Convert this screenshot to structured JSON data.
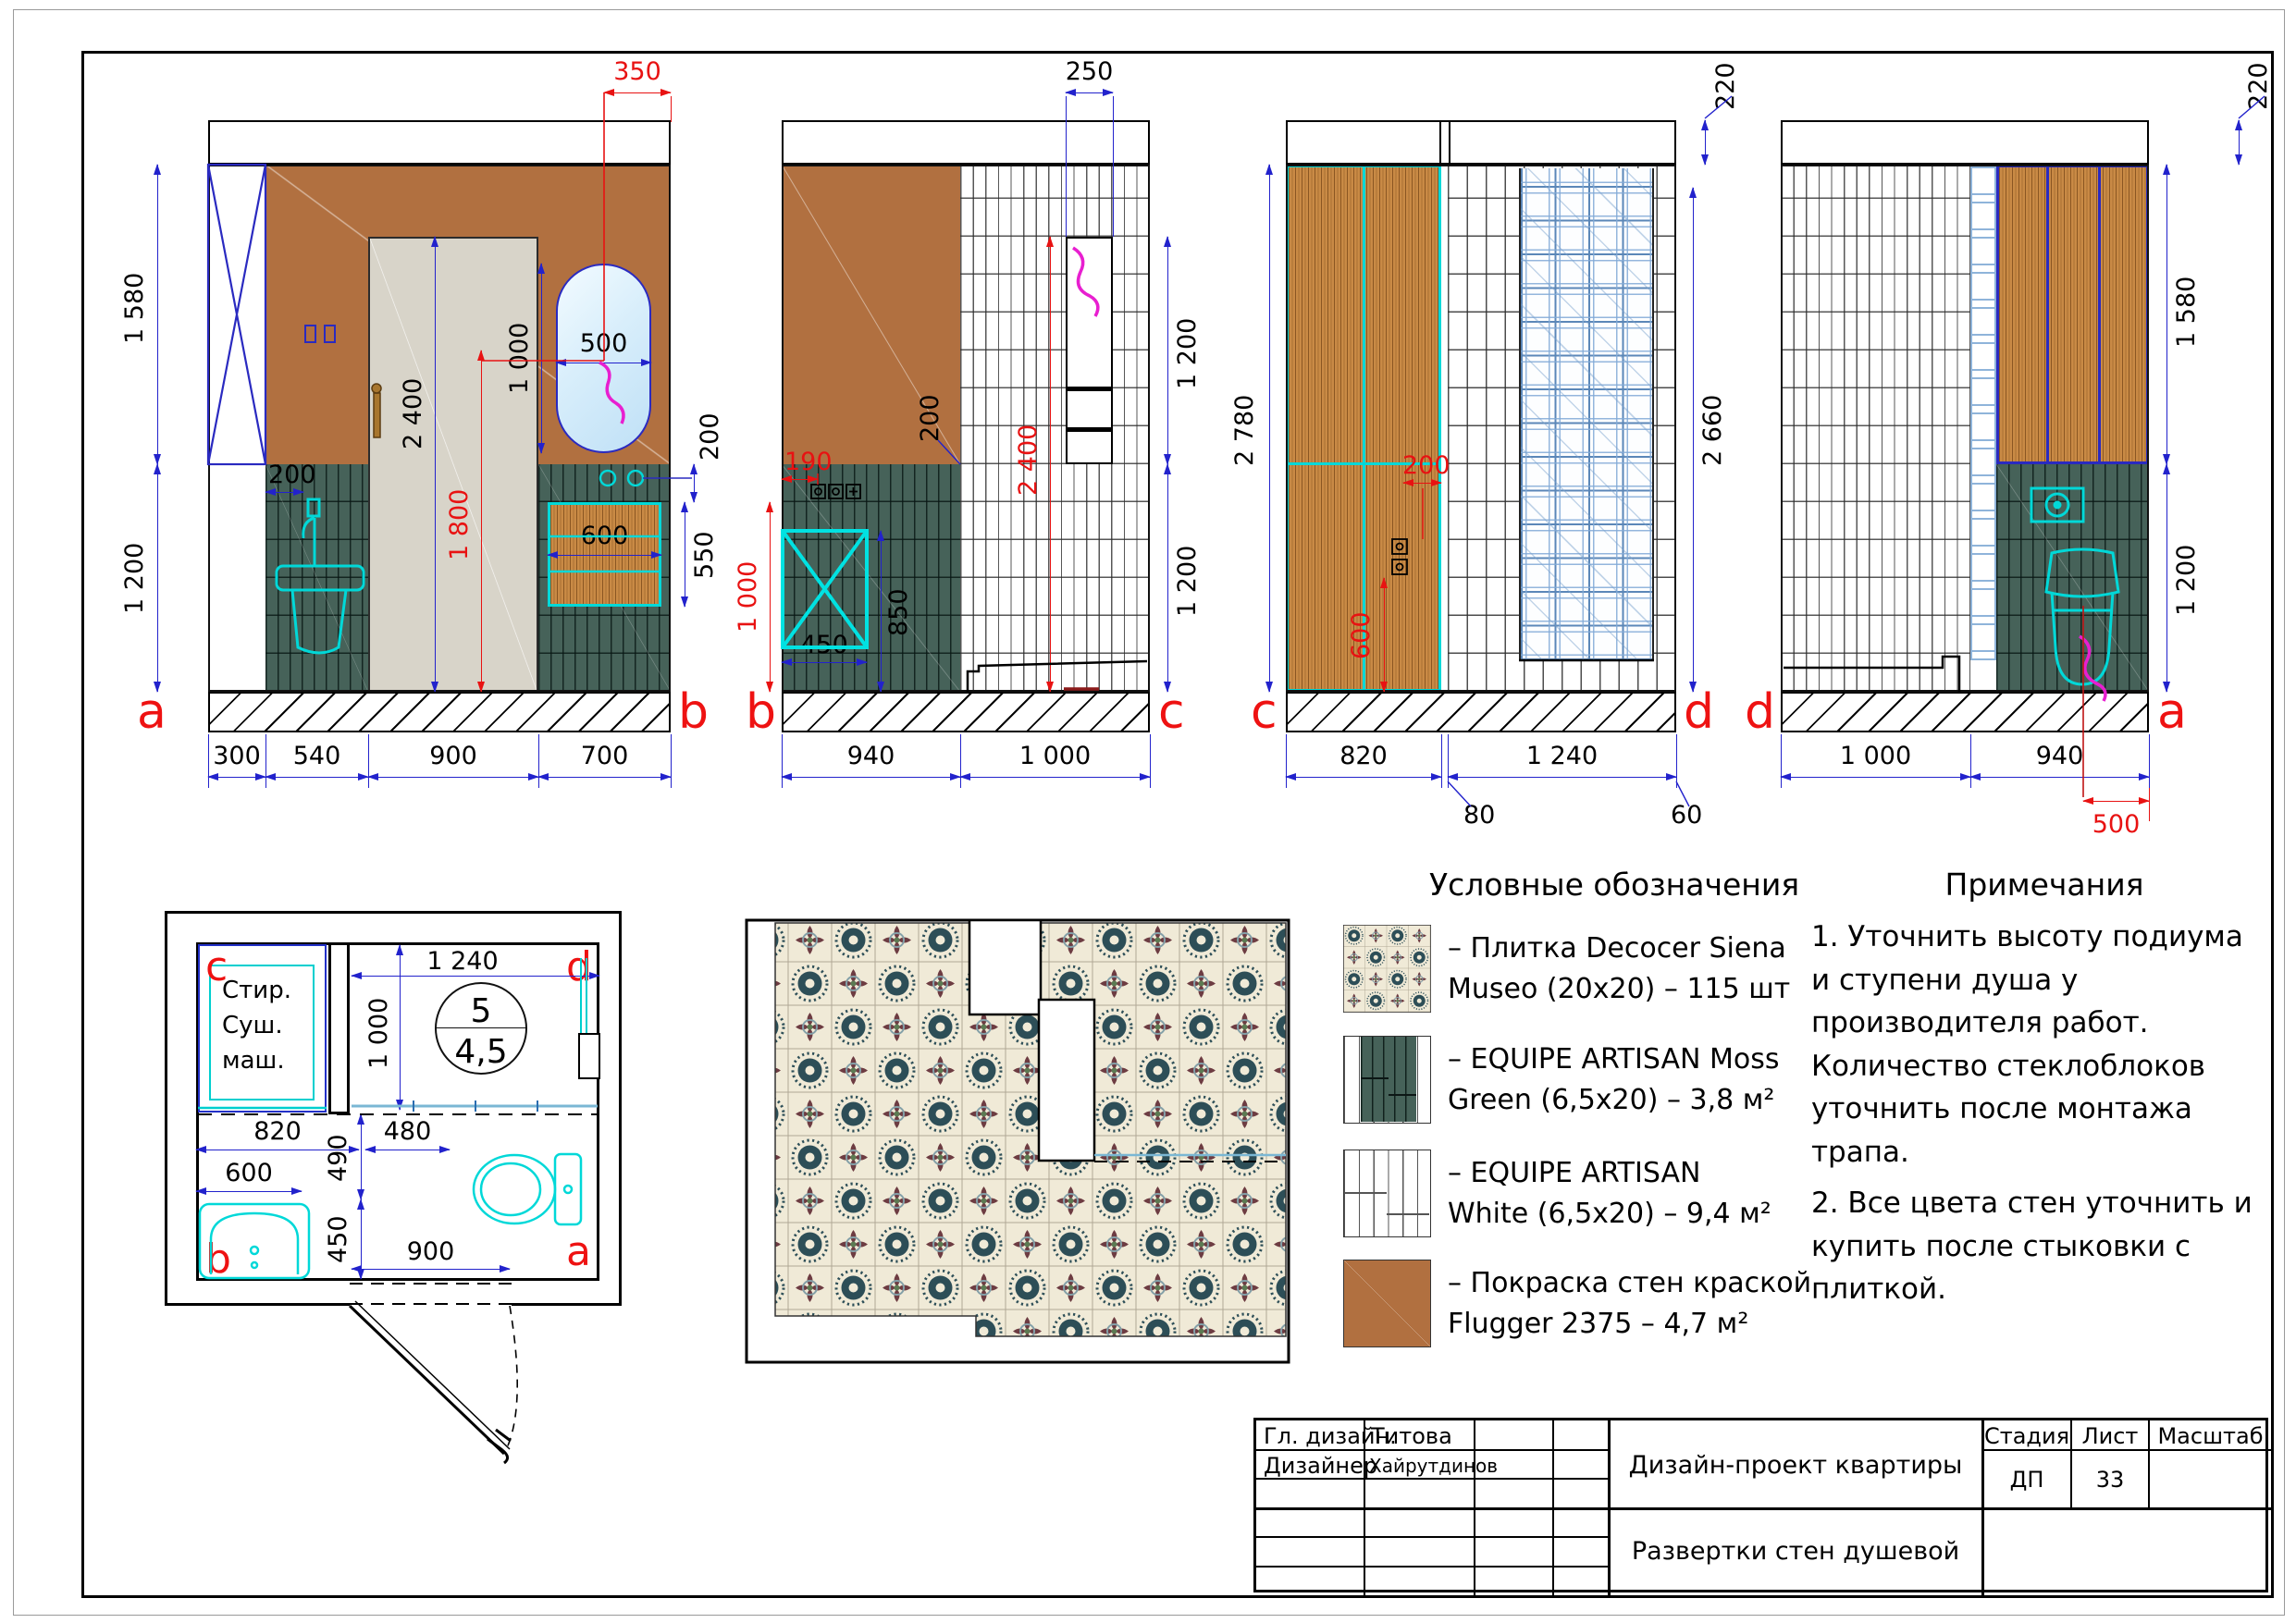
{
  "legend": {
    "title": "Условные обозначения",
    "items": [
      {
        "line1": "– Плитка Decocer Siena",
        "line2": "Museo (20x20) – 115 шт"
      },
      {
        "line1": "– EQUIPE ARTISAN Moss",
        "line2": "Green (6,5x20) – 3,8 м²"
      },
      {
        "line1": "– EQUIPE ARTISAN",
        "line2": "White (6,5x20) – 9,4 м²"
      },
      {
        "line1": "– Покраска стен краской",
        "line2": "Flugger 2375 – 4,7 м²"
      }
    ]
  },
  "notes": {
    "title": "Примечания",
    "note1": "1. Уточнить высоту подиума и ступени душа у производителя работ. Количество стеклоблоков уточнить после монтажа трапа.",
    "note2": "2. Все цвета стен уточнить и купить после стыковки с плиткой."
  },
  "titleblock": {
    "role1": "Гл. дизайн.",
    "name1": "Титова",
    "role2": "Дизайнер",
    "name2": "Хайрутдинов",
    "project": "Дизайн-проект квартиры",
    "drawing": "Развертки стен душевой",
    "stage_label": "Стадия",
    "sheet_label": "Лист",
    "scale_label": "Масштаб",
    "stage": "ДП",
    "sheet": "33"
  },
  "elev_ab": {
    "letter_left": "a",
    "letter_right": "b",
    "h_upper": "1 580",
    "h_lower": "1 200",
    "mirror_offset": "350",
    "mirror_w": "500",
    "mirror_h": "1 000",
    "door_h": "2 400",
    "hook_h": "1 800",
    "tile_offset": "200",
    "rail_offset": "200",
    "rail_w": "600",
    "rail_h": "550",
    "w1": "300",
    "w2": "540",
    "w3": "900",
    "w4": "700"
  },
  "elev_bc": {
    "letter_left": "b",
    "letter_right": "c",
    "niche_w": "250",
    "niche_h": "1 200",
    "h_lower": "1 200",
    "tile_h": "2 400",
    "mixer_off1": "190",
    "mixer_off2": "200",
    "mixer_h": "1 000",
    "box_w": "450",
    "box_h": "850",
    "w1": "940",
    "w2": "1 000"
  },
  "elev_cd": {
    "letter_left": "c",
    "letter_right": "d",
    "ceiling": "220",
    "h_total": "2 780",
    "h_tile": "2 660",
    "socket_off": "200",
    "socket_h": "600",
    "w1": "820",
    "w2": "1 240",
    "c1": "80",
    "c2": "60"
  },
  "elev_da": {
    "letter_left": "d",
    "letter_right": "a",
    "ceiling": "220",
    "h_upper": "1 580",
    "h_lower": "1 200",
    "toilet_off": "500",
    "w1": "1 000",
    "w2": "940"
  },
  "plan": {
    "c": "c",
    "d": "d",
    "b": "b",
    "a": "a",
    "room_no": "5",
    "room_area": "4,5",
    "appl1": "Стир.",
    "appl2": "Суш.",
    "appl3": "маш.",
    "d1": "1 240",
    "d2": "1 000",
    "d3": "820",
    "d4": "480",
    "d5": "600",
    "d6": "490",
    "d7": "450",
    "d8": "900"
  }
}
